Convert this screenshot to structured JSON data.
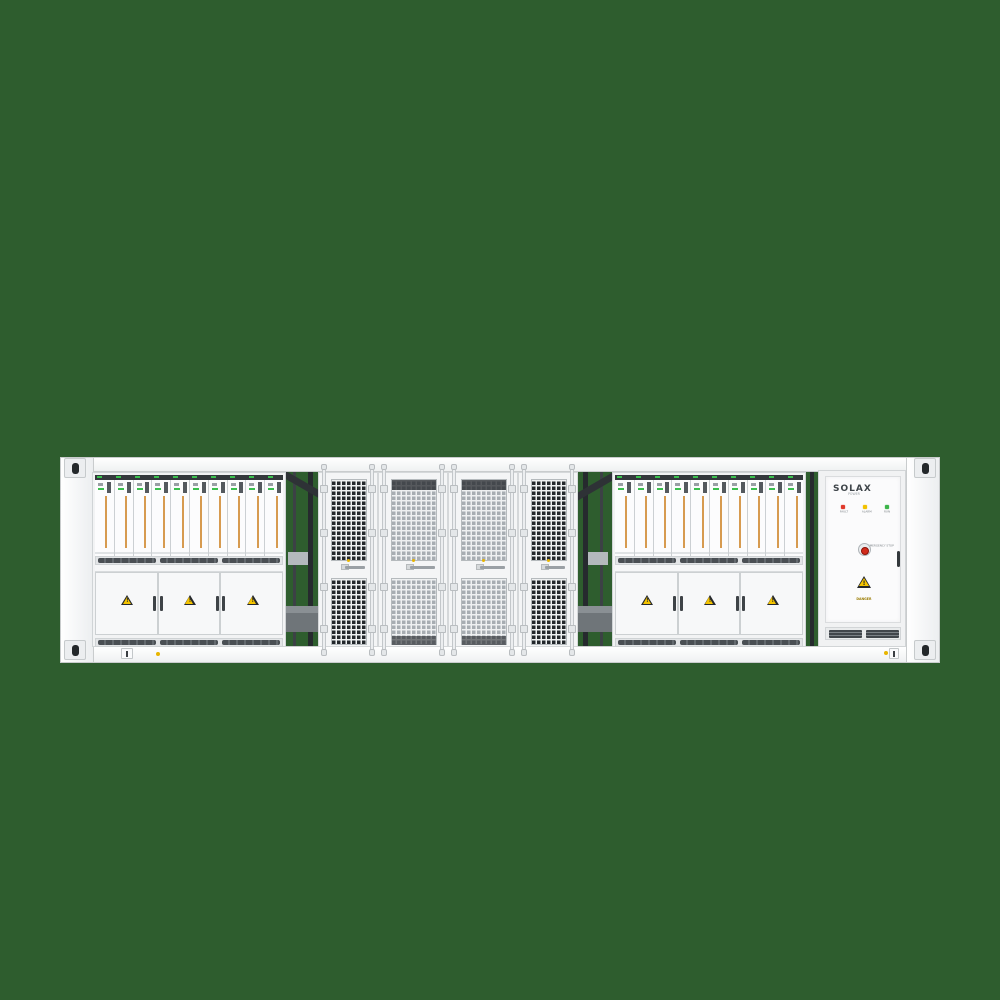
{
  "scene": {
    "background_color": "#2e5d2e"
  },
  "container": {
    "body_color": "#f2f3f4",
    "border_color": "#cfd3d5",
    "left_bay": {
      "label": "PCS Distribution Cabinet",
      "module_count": 10,
      "door_count": 3
    },
    "right_bay": {
      "label": "PCS Distribution Cabinet",
      "module_count": 10,
      "door_count": 3
    },
    "mesh_door_count": 4,
    "battery_module": {
      "stripe_color": "#d79b50",
      "led_color": "#3bbf4e"
    },
    "mesh_colors": {
      "dark": "#23272b",
      "light": "#a7adb2",
      "lattice": "#eef0f1"
    },
    "warning_triangle_color": "#f5c400",
    "warning_mark": "!"
  },
  "solax_cabinet": {
    "brand": "SOLAX",
    "brand_sub": "POWER",
    "leds": [
      {
        "label": "FAULT",
        "color": "#e0392b"
      },
      {
        "label": "ALARM",
        "color": "#f2c200"
      },
      {
        "label": "RUN",
        "color": "#3cb44a"
      }
    ],
    "estop_label": "EMERGENCY STOP",
    "danger_label": "DANGER"
  }
}
